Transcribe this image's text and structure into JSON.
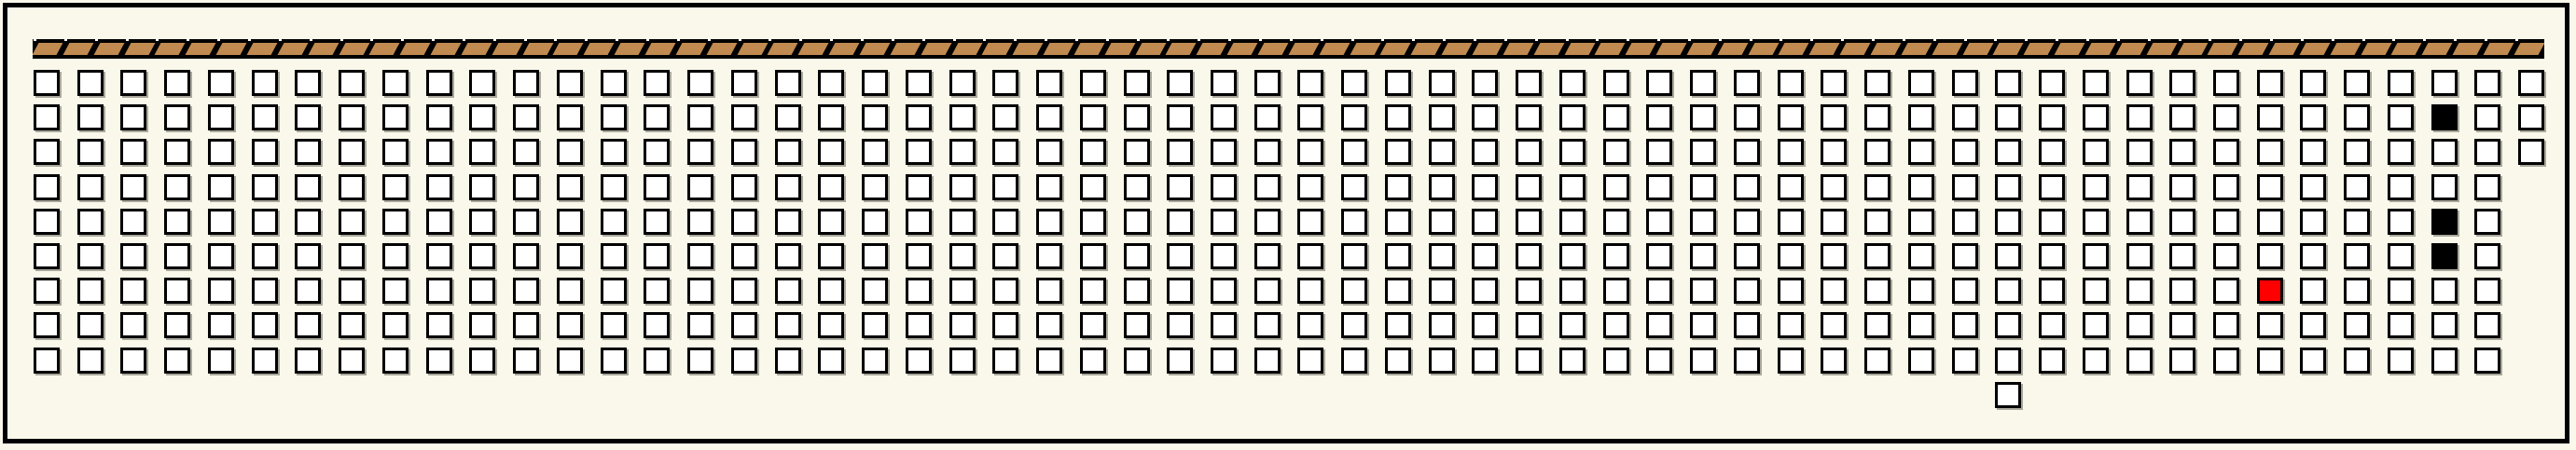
{
  "board": {
    "background_color": "#FAF8EA",
    "border_color": "#000000"
  },
  "ribbon": {
    "segment_count": 82,
    "bar_color": "#000000",
    "tan_color": "#C08A50",
    "tick_color": "#FFFFFF"
  },
  "grid": {
    "row_layout": [
      {
        "row": 1,
        "cols": 58
      },
      {
        "row": 2,
        "cols": 58
      },
      {
        "row": 3,
        "cols": 58
      },
      {
        "row": 4,
        "cols": 57
      },
      {
        "row": 5,
        "cols": 57
      },
      {
        "row": 6,
        "cols": 57
      },
      {
        "row": 7,
        "cols": 57
      },
      {
        "row": 8,
        "cols": 57
      },
      {
        "row": 9,
        "cols": 57
      }
    ],
    "black_cells": [
      {
        "row": 2,
        "col": 56
      },
      {
        "row": 5,
        "col": 56
      },
      {
        "row": 6,
        "col": 56
      }
    ],
    "red_cells": [
      {
        "row": 7,
        "col": 52
      }
    ],
    "orphan_cell": {
      "row": 10,
      "col": 46
    },
    "colors": {
      "empty_fill": "#FFFFFF",
      "black_fill": "#000000",
      "red_fill": "#FF0000",
      "cell_border": "#000000"
    }
  }
}
